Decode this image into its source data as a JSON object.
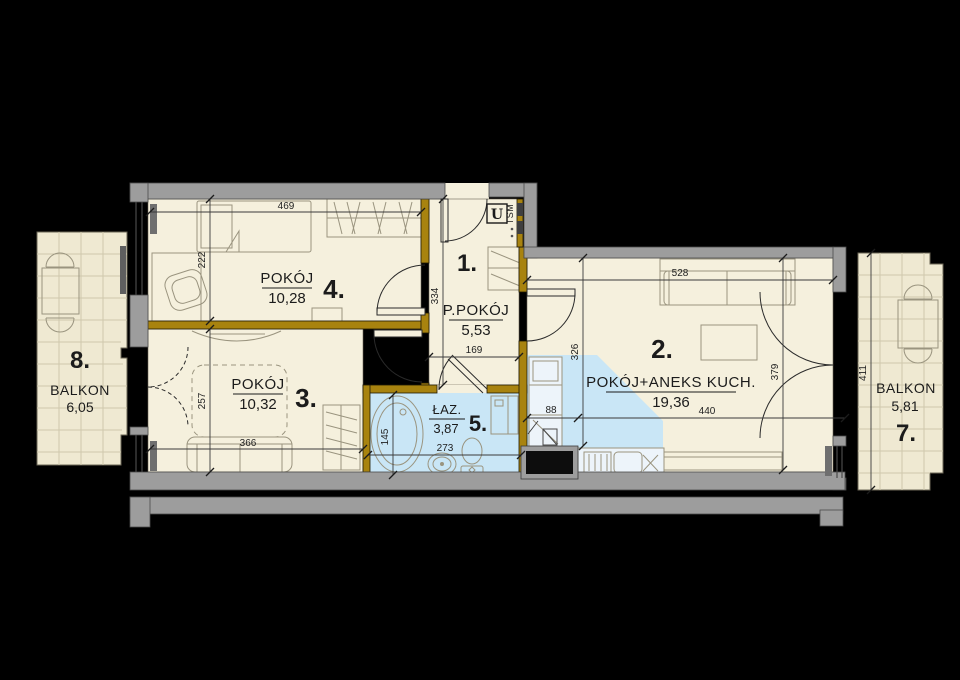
{
  "colors": {
    "background": "#000000",
    "exterior_wall": "#9d9d9d",
    "partition_wall": "#a8830f",
    "floor": "#f5f0dd",
    "balcony_floor": "#efe9d2",
    "wet_area": "#c9e6f6",
    "furniture_line": "#9a947f",
    "text": "#1b1b1b"
  },
  "rooms": [
    {
      "number": "4.",
      "name": "POKÓJ",
      "area": "10,28"
    },
    {
      "number": "1.",
      "name": "P.POKÓJ",
      "area": "5,53"
    },
    {
      "number": "2.",
      "name": "POKÓJ+ANEKS KUCH.",
      "area": "19,36"
    },
    {
      "number": "3.",
      "name": "POKÓJ",
      "area": "10,32"
    },
    {
      "number": "5.",
      "name": "ŁAZ.",
      "area": "3,87"
    },
    {
      "number": "7.",
      "name": "BALKON",
      "area": "5,81"
    },
    {
      "number": "8.",
      "name": "BALKON",
      "area": "6,05"
    }
  ],
  "markers": {
    "entrance_unit": "U",
    "entrance_code": "TSM"
  },
  "dimensions": {
    "room4_width": "469",
    "room4_depth": "222",
    "hall_depth": "334",
    "hall_width": "169",
    "room2_width_top": "528",
    "kitchen_depth": "326",
    "room2_depth_right": "379",
    "room2_width_bottom": "440",
    "kitchen_width": "88",
    "room3_depth": "257",
    "room3_width": "366",
    "bath_depth": "145",
    "bath_width": "273",
    "balcony7_depth": "411"
  }
}
